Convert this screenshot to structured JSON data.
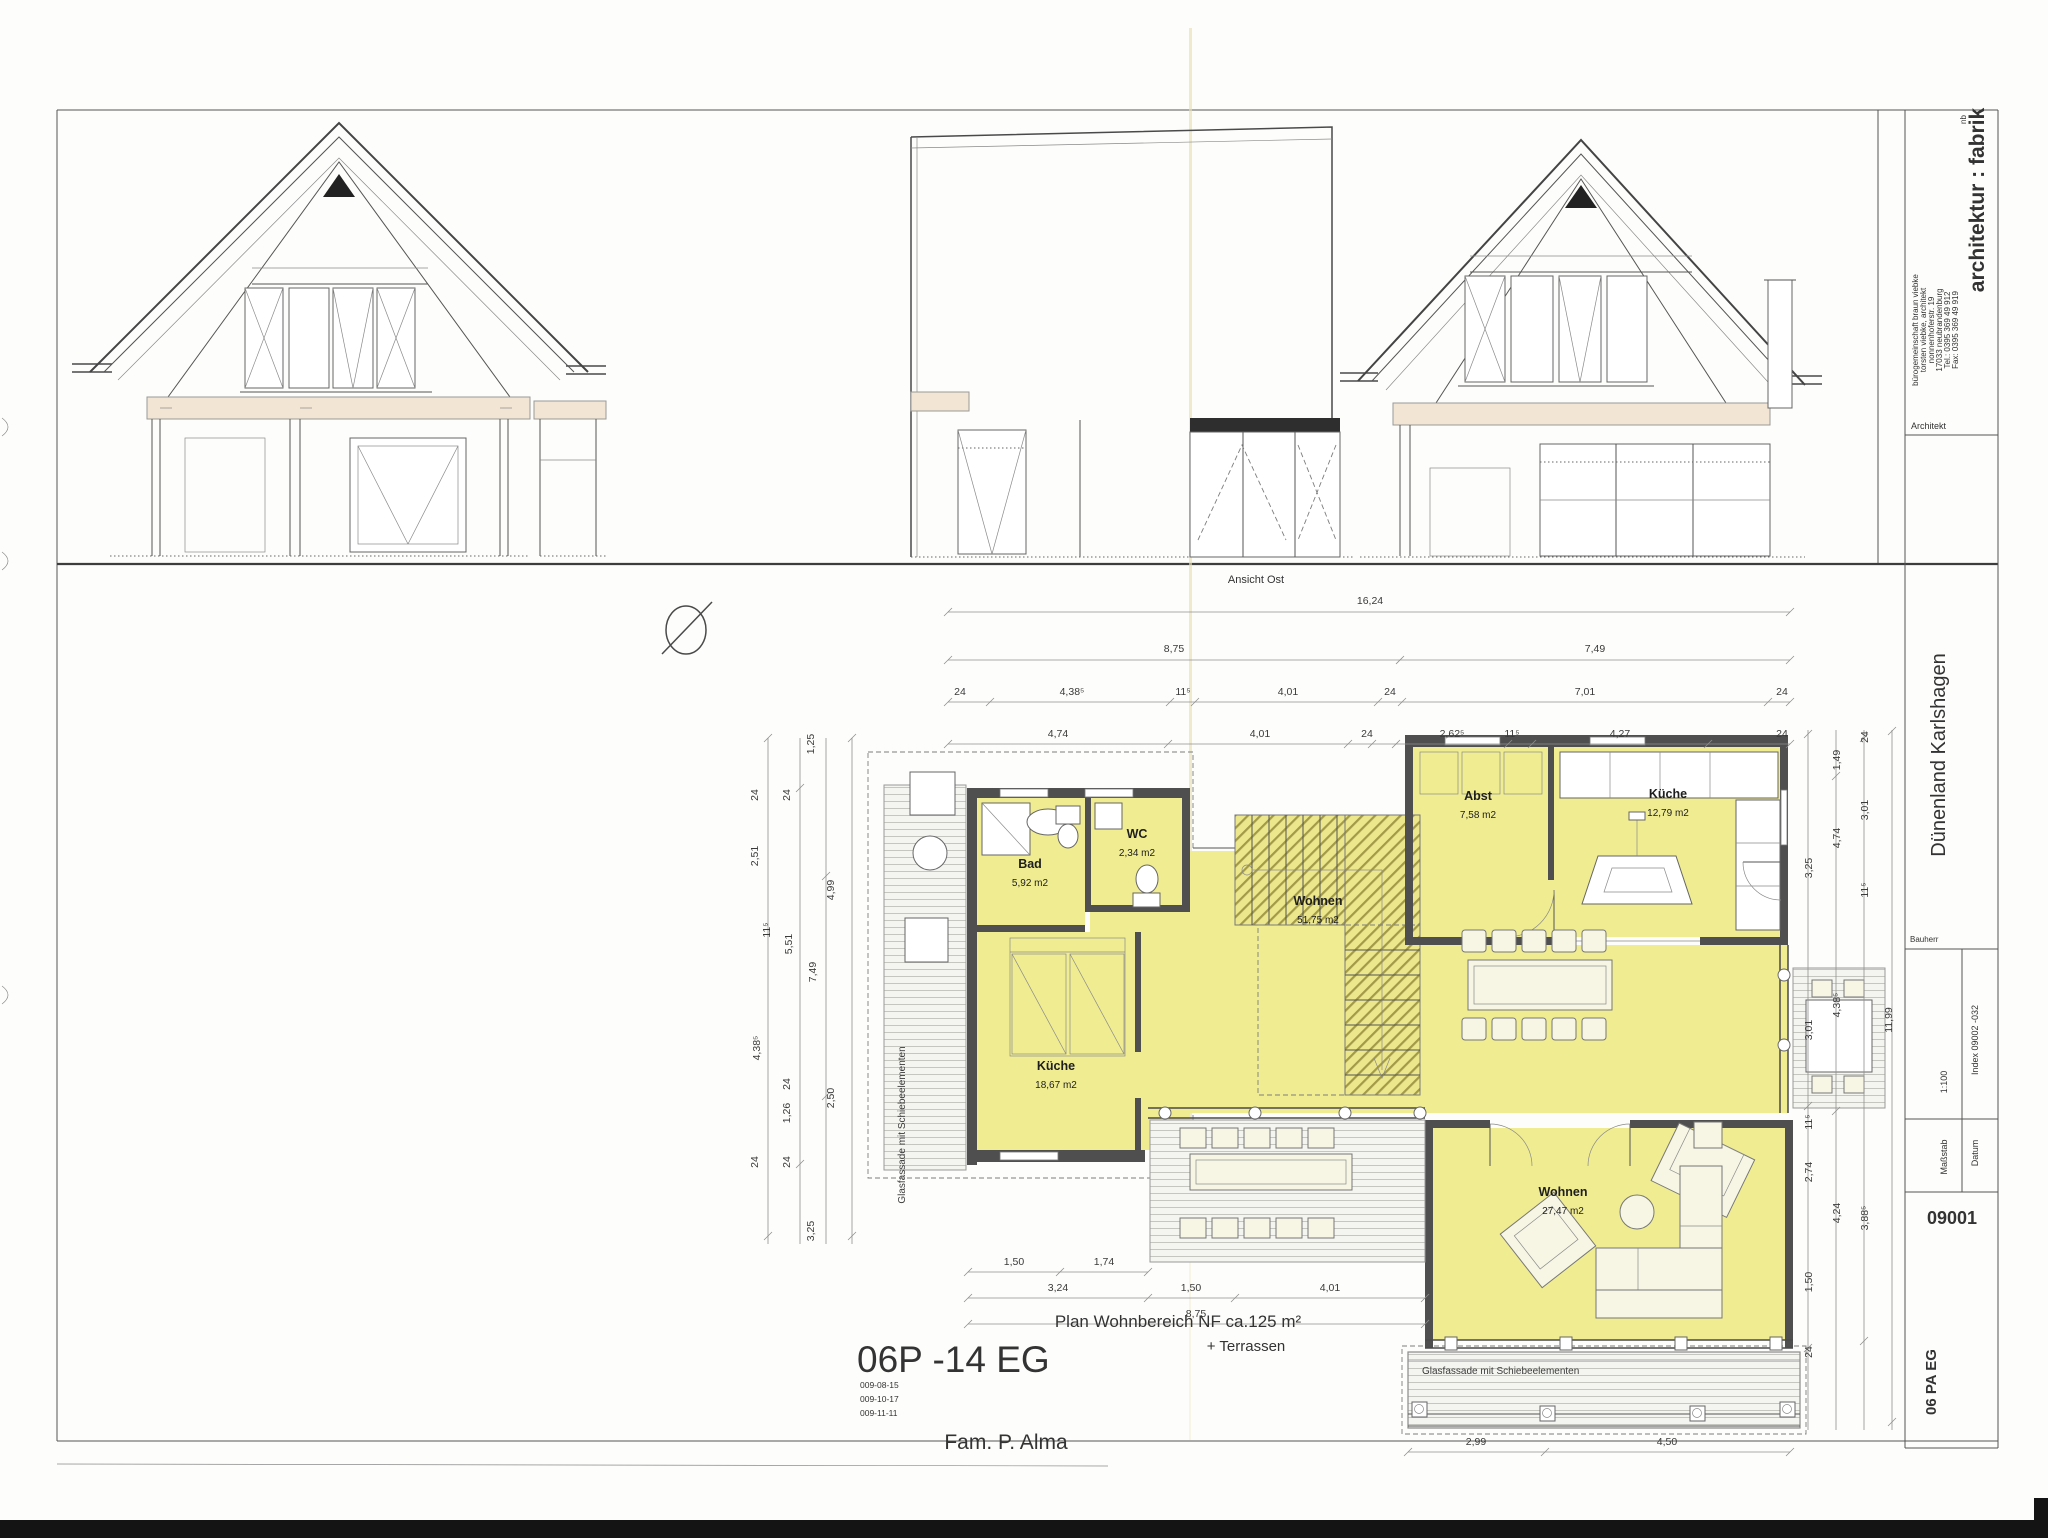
{
  "sheet": {
    "view_label": "Ansicht Ost",
    "drawing_code": "06P -14 EG",
    "revisions": [
      "009-08-15",
      "009-10-17",
      "009-11-11"
    ],
    "plan_title": "Plan Wohnbereich  NF ca.125 m²",
    "plan_subtitle": "+  Terrassen",
    "client": "Fam. P. Alma"
  },
  "title_block": {
    "brand": "architektur : fabrik",
    "brand_super": "nb",
    "office_lines": [
      "bürogemeinschaft braun viebke",
      "torsten viebke, architekt",
      "nonnenhoferstr. 19",
      "17033 neubrandenburg",
      "Tel.: 0395 369 49 912",
      "Fax: 0395 369 49 919"
    ],
    "architect_label": "Architekt",
    "project": "Dünenland Karlshagen",
    "client_label": "Bauherr",
    "scale_value": "1:100",
    "scale_label": "Maßstab",
    "index_value": "Index 09002 -032",
    "date_label": "Datum",
    "plan_number": "09001",
    "sheet_code": "06 PA EG"
  },
  "rooms": {
    "bad": {
      "name": "Bad",
      "area": "5,92 m2"
    },
    "wc": {
      "name": "WC",
      "area": "2,34 m2"
    },
    "abst": {
      "name": "Abst",
      "area": "7,58 m2"
    },
    "kueche1": {
      "name": "Küche",
      "area": "12,79 m2"
    },
    "kueche2": {
      "name": "Küche",
      "area": "18,67 m2"
    },
    "wohnen1": {
      "name": "Wohnen",
      "area": "51,75 m2"
    },
    "wohnen2": {
      "name": "Wohnen",
      "area": "27,47 m2"
    }
  },
  "notes": {
    "glass_left": "Glasfassade mit Schiebeelementen",
    "glass_bottom": "Glasfassade mit Schiebeelementen"
  },
  "dims": {
    "top": [
      "16,24",
      "8,75",
      "7,49",
      "24",
      "4,38⁵",
      "11⁵",
      "4,01",
      "24",
      "7,01",
      "24",
      "4,74",
      "4,01",
      "24",
      "2,62⁵",
      "11⁵",
      "4,27",
      "24"
    ],
    "left": [
      "1,25",
      "24",
      "24",
      "2,51",
      "11⁵",
      "5,51",
      "4,99",
      "7,49",
      "4,38⁵",
      "24",
      "1,26",
      "2,50",
      "24",
      "24",
      "3,25"
    ],
    "right": [
      "1,49",
      "24",
      "3,01",
      "4,74",
      "3,25",
      "11⁵",
      "4,38⁵",
      "3,01",
      "11,99",
      "11⁵",
      "2,74",
      "4,24",
      "3,88⁵",
      "1,50",
      "24"
    ],
    "bottom": [
      "1,50",
      "1,74",
      "3,24",
      "1,50",
      "4,01",
      "8,75"
    ],
    "terrace": [
      "2,99",
      "4,50"
    ]
  }
}
